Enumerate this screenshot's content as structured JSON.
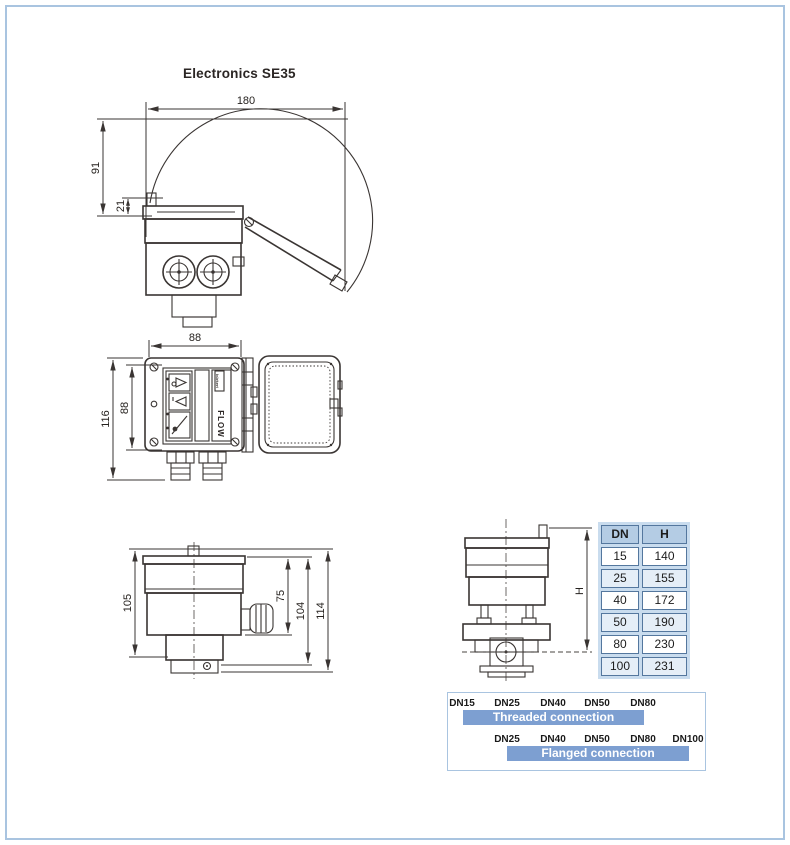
{
  "title": "Electronics SE35",
  "colors": {
    "frame_border": "#a9c4e0",
    "drawing_lines": "#3a3533",
    "table_header_bg": "#b4cce4",
    "table_alt_row_bg": "#e5eef7",
    "table_cell_border": "#54779e",
    "table_gap_bg": "#c9dcee",
    "connection_bar": "#7d9fd1",
    "connection_bar_text": "#ffffff"
  },
  "drawings": {
    "top_view": {
      "dim_width": "180",
      "dim_height": "91",
      "dim_lid": "21"
    },
    "front_view": {
      "dim_width": "88",
      "dim_outer": "116",
      "dim_inner": "88",
      "flow_label": "FLOW",
      "brand_label": "bürkert"
    },
    "side_view": {
      "dim_105": "105",
      "dim_75": "75",
      "dim_104": "104",
      "dim_114": "114"
    },
    "installed_view": {
      "dim_h": "H"
    }
  },
  "dn_table": {
    "headers": [
      "DN",
      "H"
    ],
    "rows": [
      [
        "15",
        "140"
      ],
      [
        "25",
        "155"
      ],
      [
        "40",
        "172"
      ],
      [
        "50",
        "190"
      ],
      [
        "80",
        "230"
      ],
      [
        "100",
        "231"
      ]
    ]
  },
  "connections": {
    "threaded": {
      "labels": [
        "DN15",
        "DN25",
        "DN40",
        "DN50",
        "DN80"
      ],
      "bar_label": "Threaded connection"
    },
    "flanged": {
      "labels": [
        "DN25",
        "DN40",
        "DN50",
        "DN80",
        "DN100"
      ],
      "bar_label": "Flanged connection"
    }
  }
}
